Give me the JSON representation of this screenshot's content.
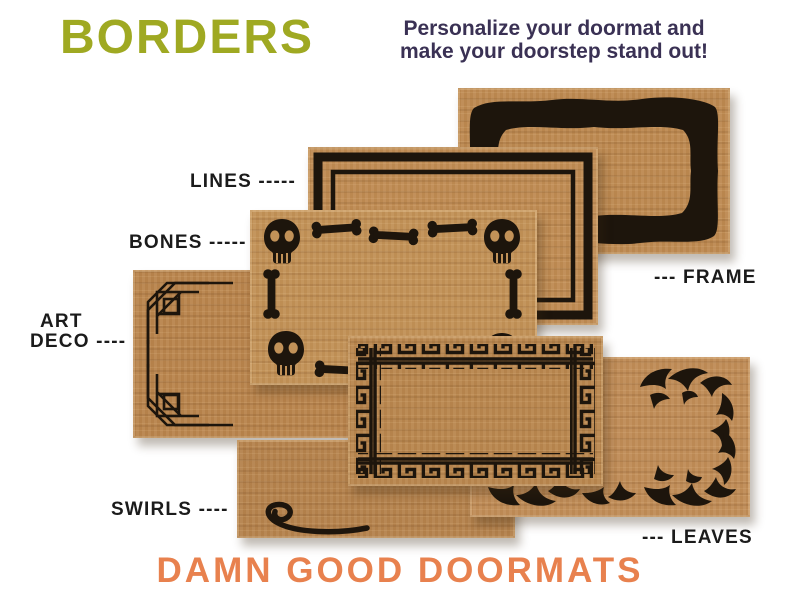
{
  "header": {
    "title": "BORDERS",
    "subtitle_line1": "Personalize your doormat and",
    "subtitle_line2": "make your doorstep stand out!"
  },
  "labels": {
    "lines": "LINES -----",
    "bones": "BONES -----",
    "art_deco_line1": "ART",
    "art_deco_line2": "DECO ----",
    "frame": "--- FRAME",
    "swirls": "SWIRLS ----",
    "leaves": "--- LEAVES"
  },
  "footer": {
    "brand": "DAMN GOOD DOORMATS"
  },
  "mats": [
    {
      "id": "frame",
      "design": "ornate picture frame border"
    },
    {
      "id": "lines",
      "design": "double line border"
    },
    {
      "id": "bones",
      "design": "skulls and bones border"
    },
    {
      "id": "art_deco",
      "design": "art deco corner border"
    },
    {
      "id": "greek_key",
      "design": "greek key border"
    },
    {
      "id": "swirls",
      "design": "swirl flourish"
    },
    {
      "id": "leaves",
      "design": "leafy foliage border"
    }
  ],
  "colors": {
    "title_green": "#9fa922",
    "subtitle_navy": "#3a3154",
    "footer_orange": "#e8814e",
    "label_black": "#1b1b1b",
    "design_black": "#1d150c",
    "mat_frame": "#bd8a52",
    "mat_lines": "#bf8c54",
    "mat_bones": "#c29258",
    "mat_art_deco": "#b9854e",
    "mat_swirls": "#b5834e",
    "mat_leaves": "#c08d58",
    "mat_greek_key": "#b9874f"
  }
}
